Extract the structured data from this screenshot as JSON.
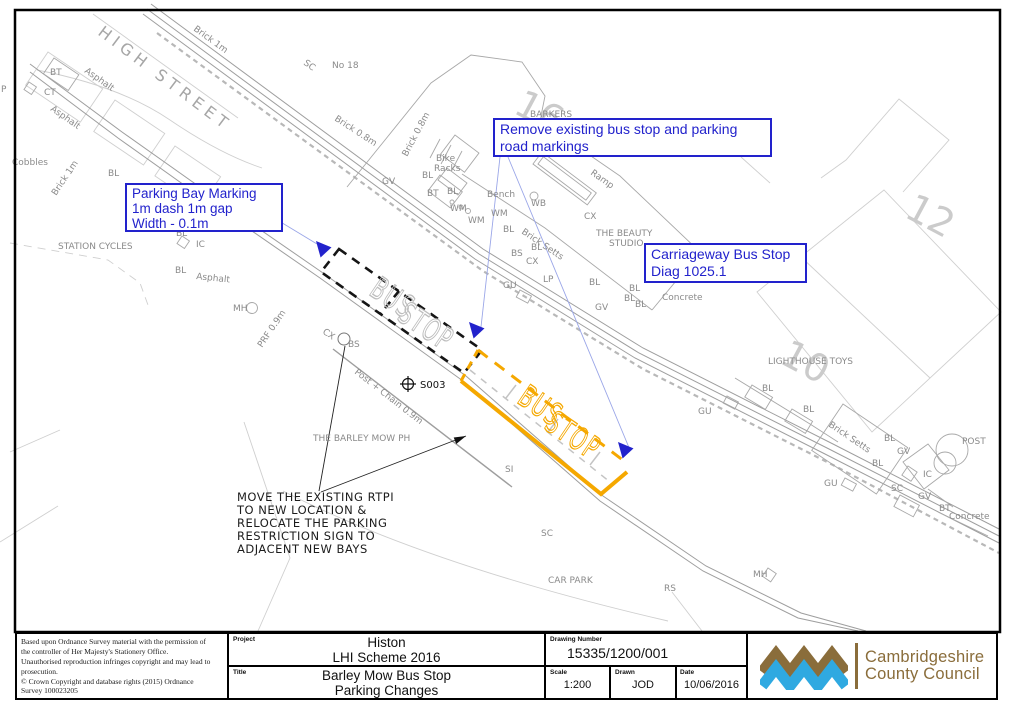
{
  "colors": {
    "annotation_blue": "#2222cc",
    "leader_blue": "#9aa6e8",
    "marking_orange": "#f5a800",
    "logo_brown": "#8a6d3b",
    "logo_blue": "#2fa9e1"
  },
  "annotations": {
    "parking_bay": {
      "lines": [
        "Parking Bay Marking",
        "1m dash 1m gap",
        "Width - 0.1m"
      ]
    },
    "remove_existing": {
      "lines": [
        "Remove existing bus stop and parking",
        "road markings"
      ]
    },
    "carriageway": {
      "lines": [
        "Carriageway Bus Stop",
        "Diag 1025.1"
      ]
    },
    "note": {
      "lines": [
        "MOVE THE EXISTING RTPI",
        "TO NEW LOCATION &",
        "RELOCATE THE PARKING",
        "RESTRICTION SIGN TO",
        "ADJACENT NEW BAYS"
      ]
    }
  },
  "map": {
    "labels": [
      {
        "t": "HIGH  STREET",
        "x": 97,
        "y": 34,
        "r": 37,
        "s": 16,
        "c": "street"
      },
      {
        "t": "Brick 1m",
        "x": 193,
        "y": 30,
        "r": 36,
        "s": 9
      },
      {
        "t": "SC",
        "x": 303,
        "y": 64,
        "r": 36,
        "s": 9
      },
      {
        "t": "No 18",
        "x": 332,
        "y": 68,
        "r": 0,
        "s": 9
      },
      {
        "t": "Brick 0.8m",
        "x": 334,
        "y": 120,
        "r": 33,
        "s": 9
      },
      {
        "t": "Brick 0.8m",
        "x": 407,
        "y": 157,
        "r": -62,
        "s": 9
      },
      {
        "t": "Bike",
        "x": 436,
        "y": 161,
        "r": 0,
        "s": 9
      },
      {
        "t": "Racks",
        "x": 434,
        "y": 171,
        "r": 0,
        "s": 9
      },
      {
        "t": "16",
        "x": 512,
        "y": 112,
        "r": 28,
        "s": 38,
        "c": "lg"
      },
      {
        "t": "BARKERS",
        "x": 530,
        "y": 117,
        "r": 0,
        "s": 9
      },
      {
        "t": "GV",
        "x": 382,
        "y": 184,
        "r": 0,
        "s": 9
      },
      {
        "t": "BL",
        "x": 422,
        "y": 178,
        "r": 0,
        "s": 9
      },
      {
        "t": "BT",
        "x": 427,
        "y": 196,
        "r": 0,
        "s": 9
      },
      {
        "t": "BL",
        "x": 447,
        "y": 194,
        "r": 0,
        "s": 9
      },
      {
        "t": "Bench",
        "x": 487,
        "y": 197,
        "r": 0,
        "s": 9
      },
      {
        "t": "WB",
        "x": 531,
        "y": 206,
        "r": 0,
        "s": 9
      },
      {
        "t": "WM",
        "x": 450,
        "y": 211,
        "r": 0,
        "s": 9
      },
      {
        "t": "WM",
        "x": 491,
        "y": 216,
        "r": 0,
        "s": 9
      },
      {
        "t": "WM",
        "x": 468,
        "y": 223,
        "r": 0,
        "s": 9
      },
      {
        "t": "Ramp",
        "x": 590,
        "y": 174,
        "r": 35,
        "s": 9
      },
      {
        "t": "CX",
        "x": 584,
        "y": 219,
        "r": 0,
        "s": 9
      },
      {
        "t": "THE BEAUTY",
        "x": 596,
        "y": 236,
        "r": 0,
        "s": 9
      },
      {
        "t": "STUDIO",
        "x": 609,
        "y": 246,
        "r": 0,
        "s": 9
      },
      {
        "t": "BL",
        "x": 503,
        "y": 232,
        "r": 0,
        "s": 9
      },
      {
        "t": "Brick Setts",
        "x": 521,
        "y": 233,
        "r": 34,
        "s": 9
      },
      {
        "t": "BL",
        "x": 531,
        "y": 250,
        "r": 0,
        "s": 9
      },
      {
        "t": "BS",
        "x": 511,
        "y": 256,
        "r": 0,
        "s": 9
      },
      {
        "t": "CX",
        "x": 526,
        "y": 264,
        "r": 0,
        "s": 9
      },
      {
        "t": "LP",
        "x": 543,
        "y": 282,
        "r": 0,
        "s": 9
      },
      {
        "t": "GU",
        "x": 503,
        "y": 288,
        "r": 0,
        "s": 9
      },
      {
        "t": "BL",
        "x": 589,
        "y": 285,
        "r": 0,
        "s": 9
      },
      {
        "t": "BL",
        "x": 629,
        "y": 291,
        "r": 0,
        "s": 9
      },
      {
        "t": "BL",
        "x": 624,
        "y": 301,
        "r": 0,
        "s": 9
      },
      {
        "t": "BL",
        "x": 635,
        "y": 307,
        "r": 0,
        "s": 9
      },
      {
        "t": "GV",
        "x": 595,
        "y": 310,
        "r": 0,
        "s": 9
      },
      {
        "t": "Concrete",
        "x": 662,
        "y": 300,
        "r": 0,
        "s": 9
      },
      {
        "t": "12",
        "x": 903,
        "y": 216,
        "r": 28,
        "s": 38,
        "c": "lg"
      },
      {
        "t": "10",
        "x": 778,
        "y": 362,
        "r": 28,
        "s": 38,
        "c": "lg"
      },
      {
        "t": "LIGHTHOUSE TOYS",
        "x": 768,
        "y": 364,
        "r": 0,
        "s": 9
      },
      {
        "t": "STATION CYCLES",
        "x": 58,
        "y": 249,
        "r": 0,
        "s": 9
      },
      {
        "t": "BL",
        "x": 176,
        "y": 236,
        "r": 0,
        "s": 9
      },
      {
        "t": "IC",
        "x": 196,
        "y": 247,
        "r": 0,
        "s": 9
      },
      {
        "t": "BL",
        "x": 175,
        "y": 273,
        "r": 0,
        "s": 9
      },
      {
        "t": "Asphalt",
        "x": 196,
        "y": 279,
        "r": 6,
        "s": 9
      },
      {
        "t": "MH",
        "x": 233,
        "y": 311,
        "r": 0,
        "s": 9
      },
      {
        "t": "PRF 0.9m",
        "x": 262,
        "y": 348,
        "r": -56,
        "s": 9
      },
      {
        "t": "Asphalt",
        "x": 84,
        "y": 72,
        "r": 35,
        "s": 9
      },
      {
        "t": "Asphalt",
        "x": 50,
        "y": 110,
        "r": 35,
        "s": 9
      },
      {
        "t": "BT",
        "x": 50,
        "y": 75,
        "r": 0,
        "s": 9
      },
      {
        "t": "CT",
        "x": 44,
        "y": 95,
        "r": 0,
        "s": 9
      },
      {
        "t": "P",
        "x": 1,
        "y": 92,
        "r": 0,
        "s": 9
      },
      {
        "t": "Cobbles",
        "x": 12,
        "y": 165,
        "r": 0,
        "s": 9
      },
      {
        "t": "Brick 1m",
        "x": 56,
        "y": 196,
        "r": -56,
        "s": 9
      },
      {
        "t": "BL",
        "x": 108,
        "y": 176,
        "r": 0,
        "s": 9
      },
      {
        "t": "CX",
        "x": 322,
        "y": 333,
        "r": 34,
        "s": 9
      },
      {
        "t": "BS",
        "x": 348,
        "y": 347,
        "r": 0,
        "s": 9
      },
      {
        "t": "Post + Chain 0.9m",
        "x": 354,
        "y": 373,
        "r": 38,
        "s": 9
      },
      {
        "t": "THE BARLEY MOW PH",
        "x": 313,
        "y": 441,
        "r": 0,
        "s": 9
      },
      {
        "t": "S003",
        "x": 420,
        "y": 388,
        "r": 0,
        "s": 10,
        "c": "dk"
      },
      {
        "t": "SI",
        "x": 505,
        "y": 472,
        "r": 0,
        "s": 9
      },
      {
        "t": "SC",
        "x": 541,
        "y": 536,
        "r": 0,
        "s": 9
      },
      {
        "t": "CAR PARK",
        "x": 548,
        "y": 583,
        "r": 0,
        "s": 9
      },
      {
        "t": "RS",
        "x": 664,
        "y": 591,
        "r": 0,
        "s": 9
      },
      {
        "t": "MH",
        "x": 753,
        "y": 577,
        "r": 0,
        "s": 9
      },
      {
        "t": "GU",
        "x": 698,
        "y": 414,
        "r": 0,
        "s": 9
      },
      {
        "t": "BL",
        "x": 762,
        "y": 391,
        "r": 0,
        "s": 9
      },
      {
        "t": "BL",
        "x": 803,
        "y": 412,
        "r": 0,
        "s": 9
      },
      {
        "t": "Brick Setts",
        "x": 828,
        "y": 426,
        "r": 34,
        "s": 9
      },
      {
        "t": "BL",
        "x": 884,
        "y": 441,
        "r": 0,
        "s": 9
      },
      {
        "t": "GV",
        "x": 897,
        "y": 454,
        "r": 0,
        "s": 9
      },
      {
        "t": "BL",
        "x": 872,
        "y": 466,
        "r": 0,
        "s": 9
      },
      {
        "t": "GU",
        "x": 824,
        "y": 486,
        "r": 0,
        "s": 9
      },
      {
        "t": "IC",
        "x": 923,
        "y": 477,
        "r": 0,
        "s": 9
      },
      {
        "t": "SC",
        "x": 891,
        "y": 491,
        "r": 0,
        "s": 9
      },
      {
        "t": "GV",
        "x": 918,
        "y": 499,
        "r": 0,
        "s": 9
      },
      {
        "t": "BT",
        "x": 939,
        "y": 511,
        "r": 0,
        "s": 9
      },
      {
        "t": "Concrete",
        "x": 949,
        "y": 519,
        "r": 0,
        "s": 9
      },
      {
        "t": "POST",
        "x": 962,
        "y": 444,
        "r": 0,
        "s": 9
      },
      {
        "t": "BUS",
        "x": 368,
        "y": 294,
        "r": 34,
        "s": 24,
        "c": "busgray"
      },
      {
        "t": "STOP",
        "x": 396,
        "y": 319,
        "r": 34,
        "s": 24,
        "c": "busgray"
      },
      {
        "t": "BUS",
        "x": 516,
        "y": 402,
        "r": 34,
        "s": 24,
        "c": "busorange"
      },
      {
        "t": "STOP",
        "x": 543,
        "y": 428,
        "r": 34,
        "s": 24,
        "c": "busorange"
      }
    ]
  },
  "title_block": {
    "copyright_lines": [
      "Based upon Ordnance Survey material with the permission of",
      "the controller of Her Majesty's Stationery Office.",
      "Unauthorised reproduction infringes copyright and may lead to",
      "prosecution.",
      "© Crown Copyright and database rights (2015) Ordnance",
      "Survey 100023205"
    ],
    "project": {
      "label": "Project",
      "lines": [
        "Histon",
        "LHI Scheme 2016"
      ]
    },
    "title": {
      "label": "Title",
      "lines": [
        "Barley Mow Bus Stop",
        "Parking Changes"
      ]
    },
    "drawing_number": {
      "label": "Drawing  Number",
      "value": "15335/1200/001"
    },
    "scale": {
      "label": "Scale",
      "value": "1:200"
    },
    "drawn": {
      "label": "Drawn",
      "value": "JOD"
    },
    "date": {
      "label": "Date",
      "value": "10/06/2016"
    },
    "logo": {
      "line1": "Cambridgeshire",
      "line2": "County Council"
    }
  }
}
